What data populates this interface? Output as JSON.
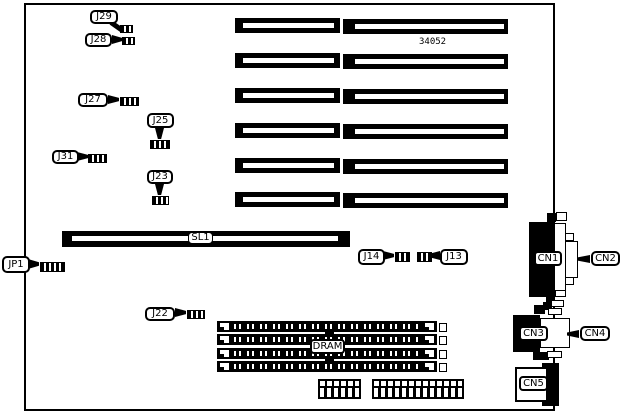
{
  "colors": {
    "ink": "#000000",
    "paper": "#ffffff"
  },
  "board": {
    "part_number": "34052",
    "callouts": {
      "j29": "J29",
      "j28": "J28",
      "j27": "J27",
      "j25": "J25",
      "j31": "J31",
      "j23": "J23",
      "jp1": "JP1",
      "j22": "J22",
      "j14": "J14",
      "j13": "J13",
      "cn2": "CN2",
      "cn4": "CN4"
    },
    "labels": {
      "sl1": "SL1",
      "dram": "DRAM",
      "cn1": "CN1",
      "cn3": "CN3",
      "cn5": "CN5"
    },
    "slots": {
      "left_column_count": 6,
      "right_column_count": 6
    },
    "memory": {
      "simm_sockets": 4
    }
  }
}
